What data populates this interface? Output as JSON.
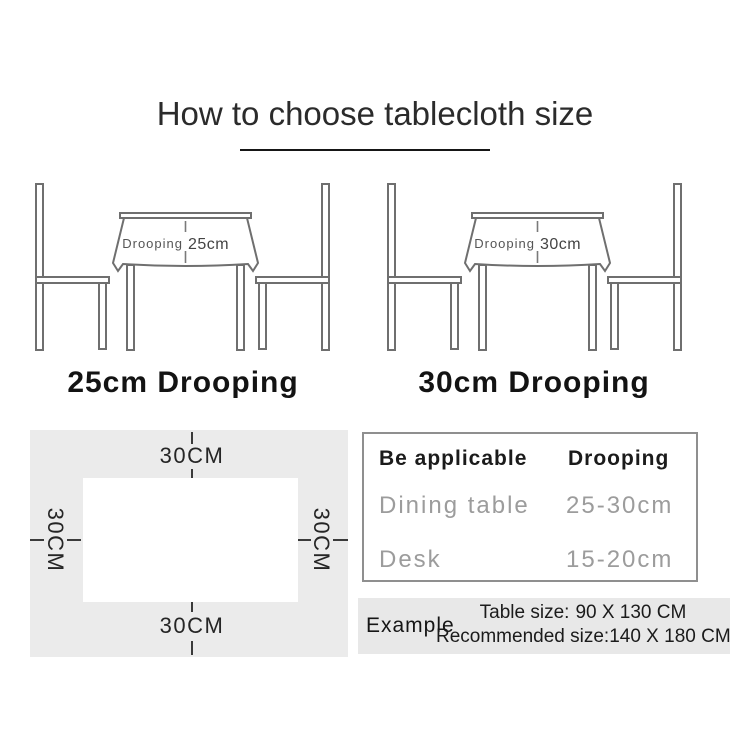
{
  "title": "How to choose tablecloth size",
  "illustrations": [
    {
      "drooping_word": "Drooping",
      "drooping_value": "25cm",
      "caption": "25cm Drooping"
    },
    {
      "drooping_word": "Drooping",
      "drooping_value": "30cm",
      "caption": "30cm Drooping"
    }
  ],
  "size_diagram": {
    "top_label": "30CM",
    "bottom_label": "30CM",
    "left_label": "30CM",
    "right_label": "30CM"
  },
  "spec_table": {
    "header": {
      "col1": "Be applicable",
      "col2": "Drooping"
    },
    "rows": [
      {
        "col1": "Dining table",
        "col2": "25-30cm"
      },
      {
        "col1": "Desk",
        "col2": "15-20cm"
      }
    ]
  },
  "example": {
    "label": "Example",
    "table_size_label": "Table size:",
    "table_size_value": "90 X 130 CM",
    "recommended_label": "Recommended size:",
    "recommended_value": "140 X 180 CM"
  },
  "colors": {
    "line_art": "#6f6f6f",
    "diagram_bg": "#ebebeb",
    "example_bg": "#e8e8e8",
    "muted_text": "#9c9c9c",
    "ink": "#1b1b1b"
  }
}
